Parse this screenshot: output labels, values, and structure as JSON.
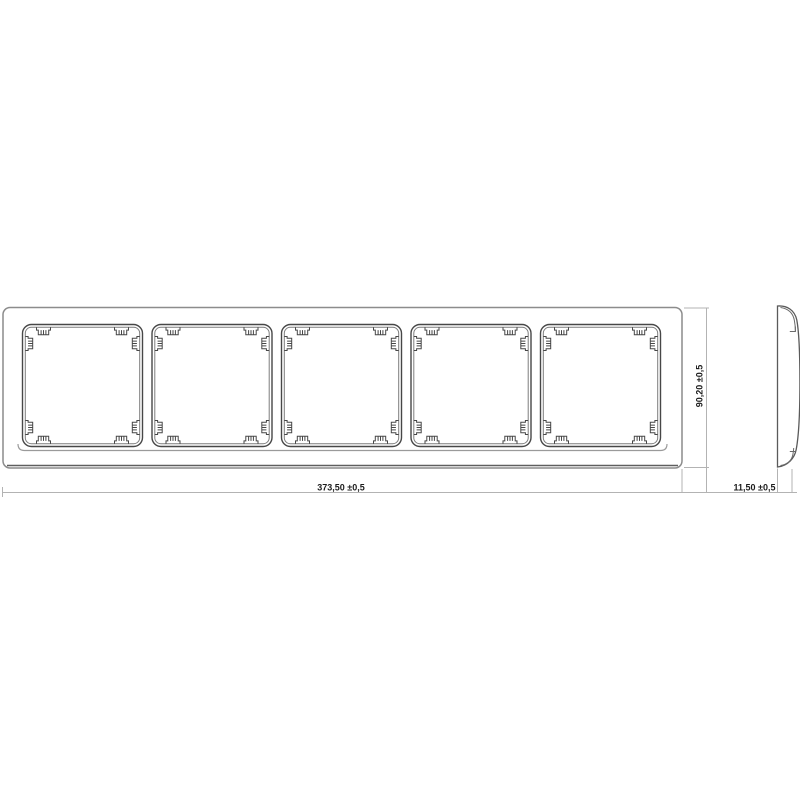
{
  "drawing": {
    "type": "technical-drawing",
    "subject": "5-gang frame, front and side view",
    "openings_count": 5,
    "dimensions": {
      "width": {
        "label": "373,50 ±0,5",
        "orientation": "horizontal",
        "applies_to": "front-view-width"
      },
      "height": {
        "label": "90,20 ±0,5",
        "orientation": "vertical",
        "applies_to": "front-view-height"
      },
      "depth": {
        "label": "11,50 ±0,5",
        "orientation": "horizontal",
        "applies_to": "side-view-depth"
      }
    },
    "colors": {
      "background": "#ffffff",
      "outer_frame_line": "#8c8c8c",
      "opening_line": "#474747",
      "opening_inner_line": "#7d7d7d",
      "side_view_line": "#5a5a5a",
      "dimension_line": "#b3b3b3",
      "dimension_text": "#1c1c1c"
    }
  }
}
